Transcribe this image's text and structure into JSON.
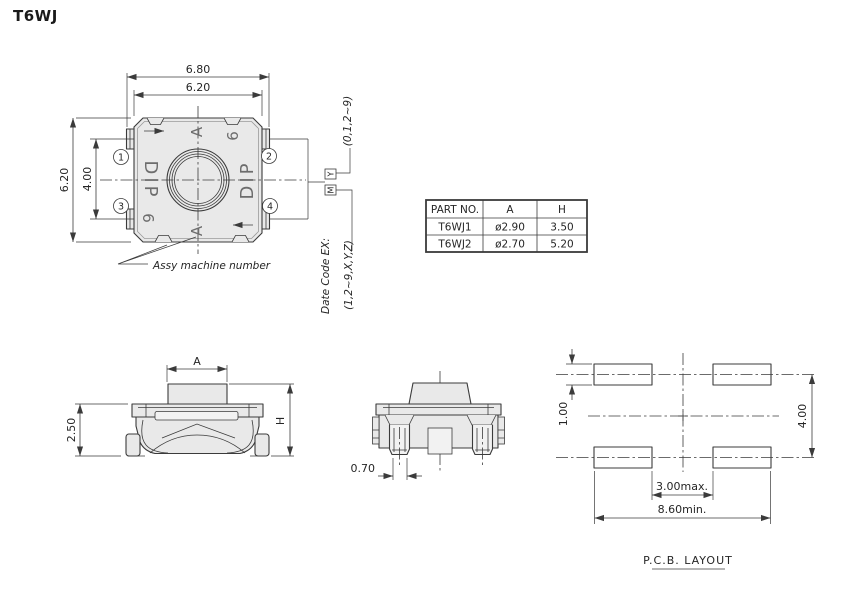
{
  "title": "T6WJ",
  "top_view": {
    "dims": {
      "outer_width": "6.80",
      "body_width": "6.20",
      "body_height": "6.20",
      "terminal_pitch": "4.00"
    },
    "pins": [
      "1",
      "2",
      "3",
      "4"
    ],
    "marks": {
      "letter_top": "A",
      "letter_bottom": "A",
      "word_left": "DIP",
      "word_right": "DIP",
      "digit_top_right": "6",
      "digit_bottom_left": "6"
    },
    "note": "Assy machine number"
  },
  "date_code": {
    "title": "Date Code EX:",
    "month_values": "(1,2~9,X,Y,Z)",
    "year_values": "(0,1,2~9)",
    "month_mark": "M",
    "year_mark": "Y"
  },
  "spec_table": {
    "headers": [
      "PART NO.",
      "A",
      "H"
    ],
    "rows": [
      [
        "T6WJ1",
        "ø2.90",
        "3.50"
      ],
      [
        "T6WJ2",
        "ø2.70",
        "5.20"
      ]
    ]
  },
  "front_view": {
    "dim_button_dia": "A",
    "dim_body_height": "2.50",
    "dim_total_height": "H"
  },
  "side_view": {
    "dim_terminal_width": "0.70"
  },
  "pcb_layout": {
    "dim_pad_height": "1.00",
    "dim_row_pitch": "4.00",
    "dim_inner_gap": "3.00max.",
    "dim_outer_span": "8.60min.",
    "caption": "P.C.B. LAYOUT"
  }
}
